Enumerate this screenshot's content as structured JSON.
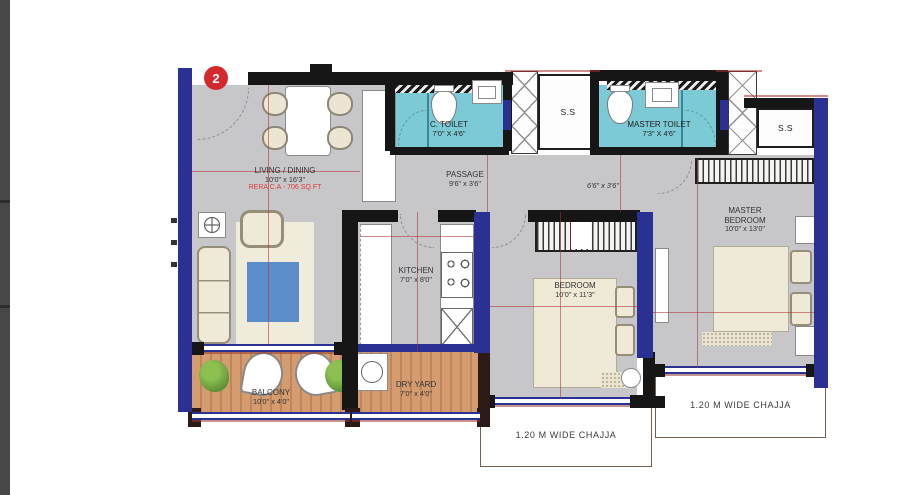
{
  "plan": {
    "unit_badge": "2",
    "rooms": {
      "living_dining": {
        "name": "LIVING / DINING",
        "dim": "10'0\" x 16'3\"",
        "rera": "RERA C.A - 706 SQ.FT"
      },
      "c_toilet": {
        "name": "C. TOILET",
        "dim": "7'0\" X 4'6\""
      },
      "ss_left": {
        "name": "S.S"
      },
      "master_toilet": {
        "name": "MASTER TOILET",
        "dim": "7'3\" X 4'6\""
      },
      "ss_right": {
        "name": "S.S"
      },
      "passage": {
        "name": "PASSAGE",
        "dim": "9'6\" x 3'6\""
      },
      "passage_ext": {
        "dim": "6'6\" x 3'6\""
      },
      "kitchen": {
        "name": "KITCHEN",
        "dim": "7'0\" x 8'0\""
      },
      "bedroom": {
        "name": "BEDROOM",
        "dim": "10'0\" x 11'3\""
      },
      "master_bedroom": {
        "name": "MASTER BEDROOM",
        "dim": "10'0\" x 13'0\""
      },
      "balcony": {
        "name": "BALCONY",
        "dim": "10'0\" x 4'0\""
      },
      "dry_yard": {
        "name": "DRY YARD",
        "dim": "7'0\" x 4'0\""
      },
      "chajja_bottom": {
        "label": "1.20 M WIDE CHAJJA"
      },
      "chajja_right": {
        "label": "1.20 M WIDE CHAJJA"
      }
    },
    "colors": {
      "wall_navy": "#2b3192",
      "wall_black": "#161616",
      "toilet_cyan": "#7bcad5",
      "deck_wood": "#d59c6f",
      "floor_gray": "#c7c7ca",
      "badge_red": "#d4282f",
      "rera_red": "#e03c3c",
      "rug_blue": "#5b8dca",
      "plant_green": "#7ab648"
    }
  }
}
